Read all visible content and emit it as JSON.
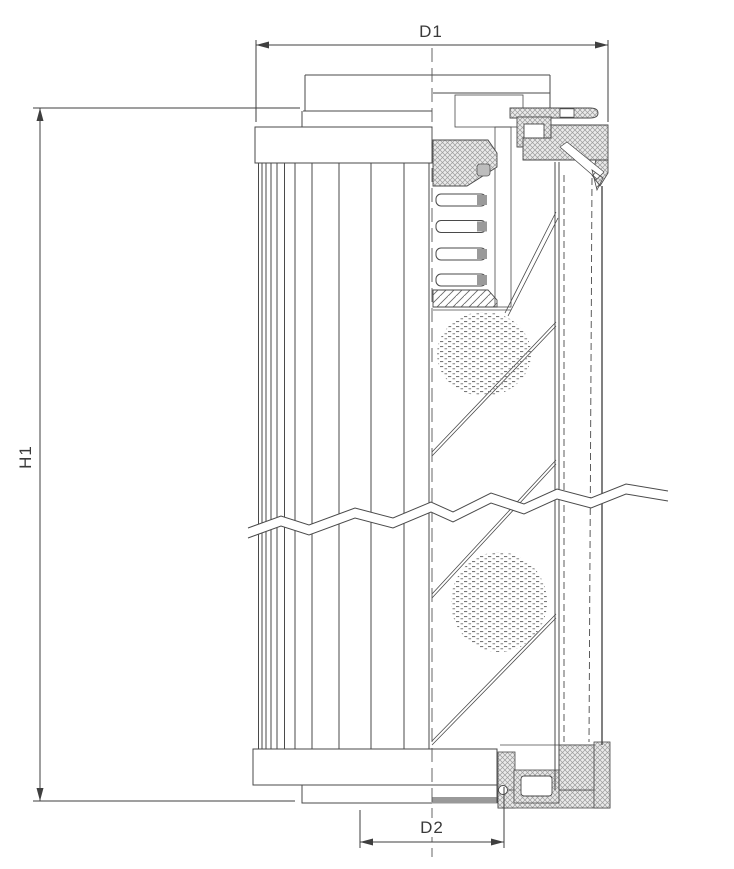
{
  "drawing": {
    "type": "technical-section-drawing",
    "labels": {
      "d1": "D1",
      "h1": "H1",
      "d2": "D2"
    },
    "colors": {
      "line": "#4a4a4a",
      "dimension_line": "#3f3f3f",
      "text": "#3a3a3a",
      "seal_stipple": "#9b9b9b",
      "perforation_speckle": "#787878",
      "gray_bar": "#999999",
      "background": "#ffffff"
    }
  }
}
